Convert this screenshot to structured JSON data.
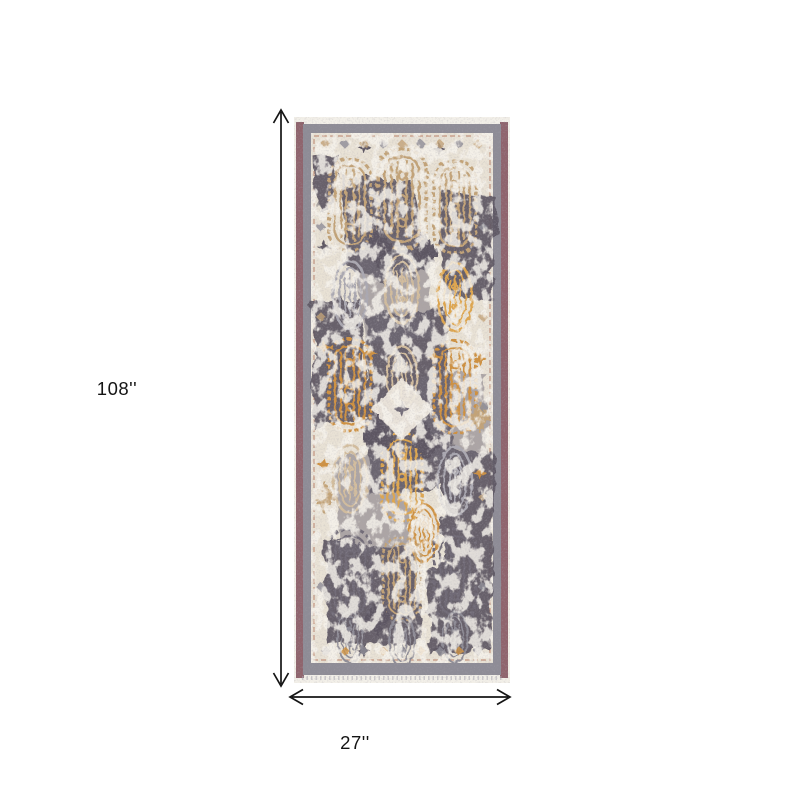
{
  "diagram": {
    "kind": "rug-dimension-diagram",
    "height_label": "108''",
    "width_label": "27''"
  },
  "palette": {
    "ink": "#141414",
    "edge": "#f3f0e9",
    "cream": "#e9e2d5",
    "cream2": "#f0eadf",
    "tan": "#c3a377",
    "beige": "#d3bd9d",
    "orange": "#cf9140",
    "orange2": "#dfa64e",
    "charcoal": "#5d5762",
    "charcoal2": "#6f6a76",
    "gray": "#8e8c96",
    "grayl": "#aaa8b1",
    "maroon": "#7c4b57",
    "rust": "#b06a4e"
  }
}
